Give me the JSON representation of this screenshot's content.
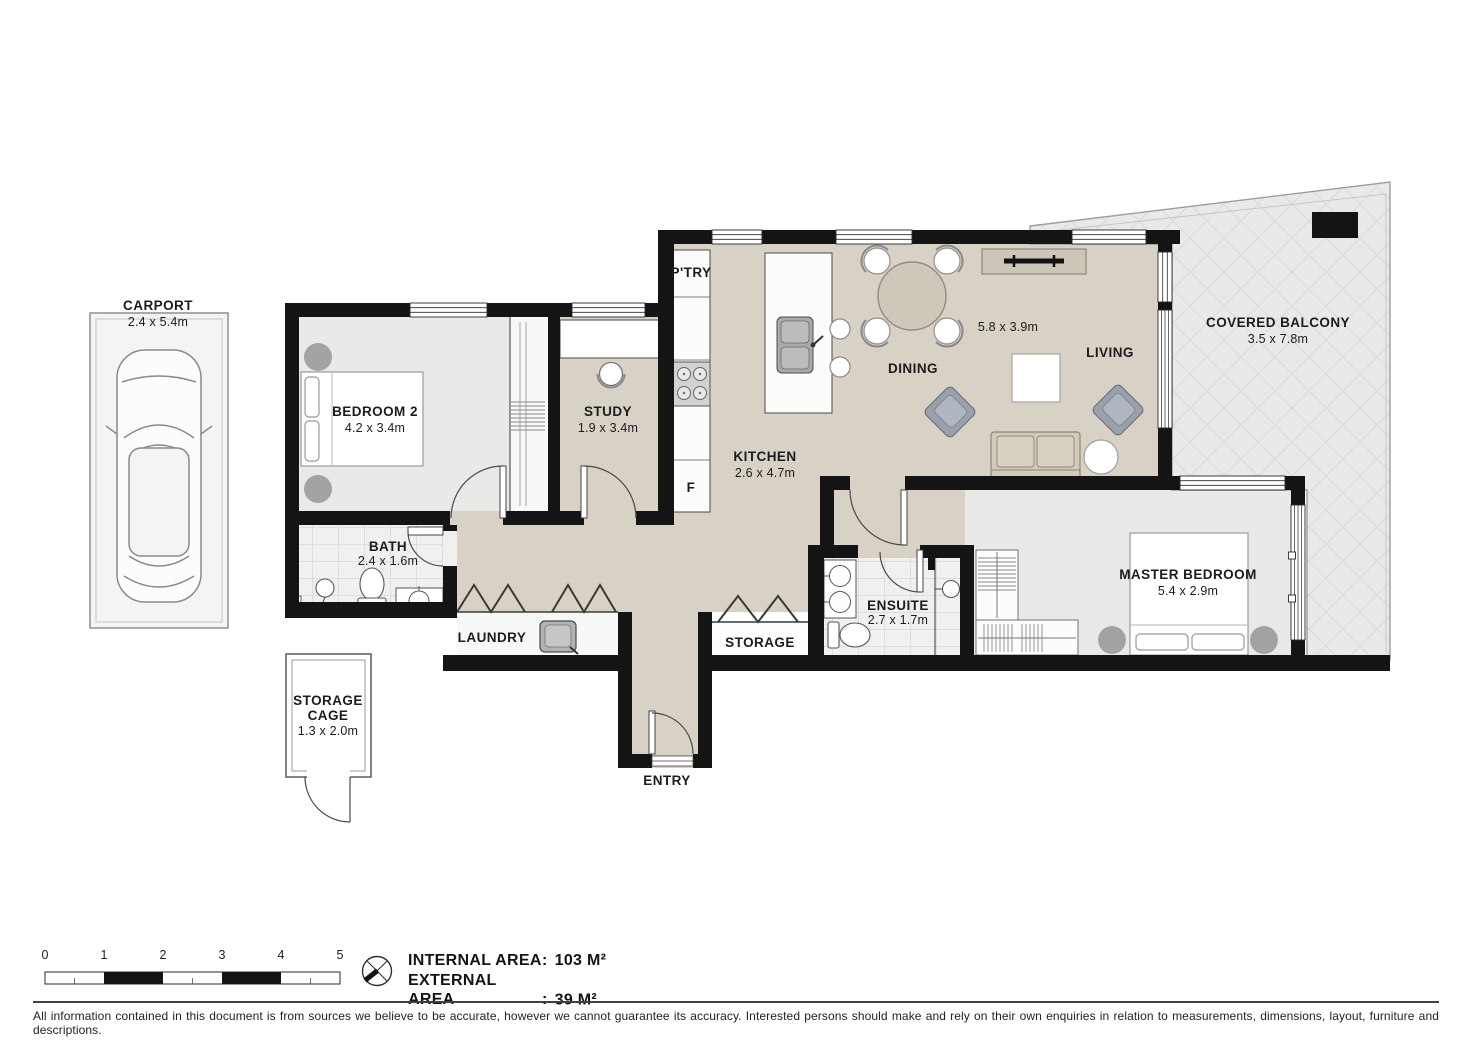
{
  "rooms": {
    "carport": {
      "label": "CARPORT",
      "dim": "2.4 x 5.4m"
    },
    "bedroom2": {
      "label": "BEDROOM 2",
      "dim": "4.2 x 3.4m"
    },
    "study": {
      "label": "STUDY",
      "dim": "1.9 x 3.4m"
    },
    "pantry": {
      "label": "P'TRY"
    },
    "fridge": {
      "label": "F"
    },
    "kitchen": {
      "label": "KITCHEN",
      "dim": "2.6 x 4.7m"
    },
    "dining": {
      "label": "DINING",
      "dim": "5.8 x 3.9m"
    },
    "living": {
      "label": "LIVING"
    },
    "balcony": {
      "label": "COVERED BALCONY",
      "dim": "3.5 x 7.8m"
    },
    "bath": {
      "label": "BATH",
      "dim": "2.4 x 1.6m"
    },
    "laundry": {
      "label": "LAUNDRY"
    },
    "storage": {
      "label": "STORAGE"
    },
    "ensuite": {
      "label": "ENSUITE",
      "dim": "2.7 x 1.7m"
    },
    "master_bedroom": {
      "label": "MASTER BEDROOM",
      "dim": "5.4 x 2.9m"
    },
    "storage_cage": {
      "line1": "STORAGE",
      "line2": "CAGE",
      "dim": "1.3 x 2.0m"
    },
    "entry": {
      "label": "ENTRY"
    }
  },
  "scale_bar": {
    "ticks": [
      "0",
      "1",
      "2",
      "3",
      "4",
      "5"
    ]
  },
  "areas": {
    "internal": {
      "label": "INTERNAL AREA",
      "colon": ":",
      "value": "103 M²"
    },
    "external": {
      "label": "EXTERNAL AREA",
      "colon": ":",
      "value": "39 M²"
    }
  },
  "disclaimer": "All information contained in this document is from sources we believe to be accurate, however we cannot guarantee its accuracy. Interested persons should make and rely on their own enquiries in relation to measurements, dimensions, layout, furniture and descriptions.",
  "colors": {
    "wall": "#141414",
    "floor_main": "#d8d1c5",
    "floor_bedroom": "#e9e9e8",
    "floor_balcony": "#e9e9ea",
    "tile": "#f0f0ee",
    "armchair": "#9ba1ac",
    "sofa": "#d2cbbb",
    "table": "#cfc8ba"
  }
}
